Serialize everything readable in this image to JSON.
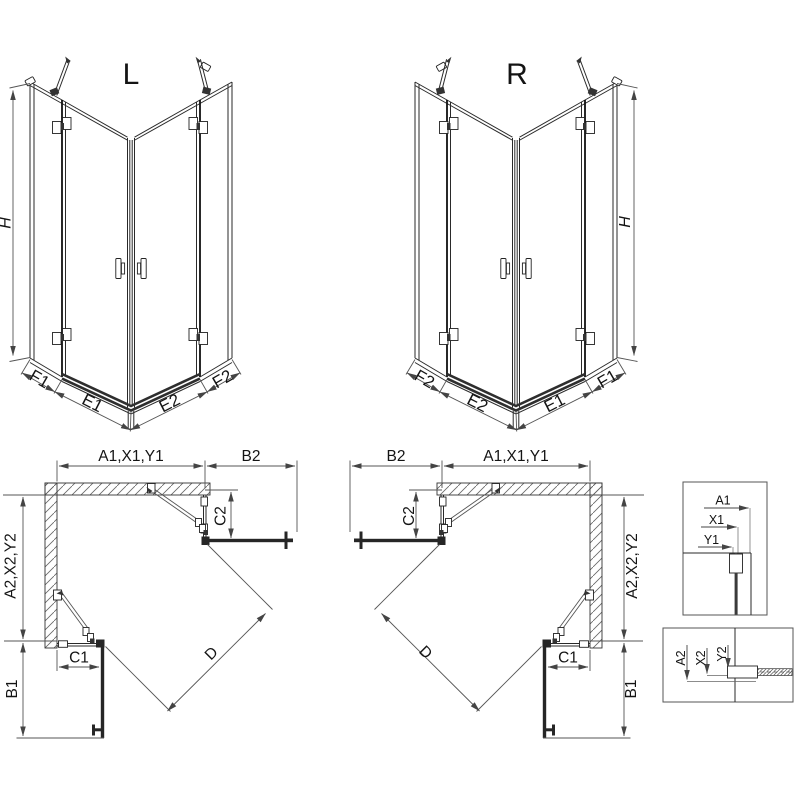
{
  "views_3d": {
    "left": {
      "title": "L",
      "height_label": "H",
      "bottom_segments": {
        "f_left": "F1",
        "e_left": "E1",
        "e_right": "E2",
        "f_right": "F2"
      }
    },
    "right": {
      "title": "R",
      "height_label": "H",
      "bottom_segments": {
        "f_left": "F2",
        "e_left": "E2",
        "e_right": "E1",
        "f_right": "F1"
      }
    }
  },
  "plans": {
    "left": {
      "top_width": "A1,X1,Y1",
      "top_right_width": "B2",
      "left_depth": "A2,X2,Y2",
      "fixed_top": "C2",
      "fixed_bottom": "C1",
      "diagonal": "D",
      "door_depth": "B1"
    },
    "right": {
      "top_left_width": "B2",
      "top_width": "A1,X1,Y1",
      "fixed_top": "C2",
      "right_depth": "A2,X2,Y2",
      "diagonal": "D",
      "fixed_bottom": "C1",
      "door_depth": "B1"
    }
  },
  "details": {
    "wall_profile_top": {
      "a": "A1",
      "x": "X1",
      "y": "Y1"
    },
    "wall_profile_bottom": {
      "a": "A2",
      "x": "X2",
      "y": "Y2"
    }
  },
  "colors": {
    "line": "#2a2a2a",
    "dim": "#555555",
    "dark": "#262626",
    "background": "#ffffff"
  }
}
